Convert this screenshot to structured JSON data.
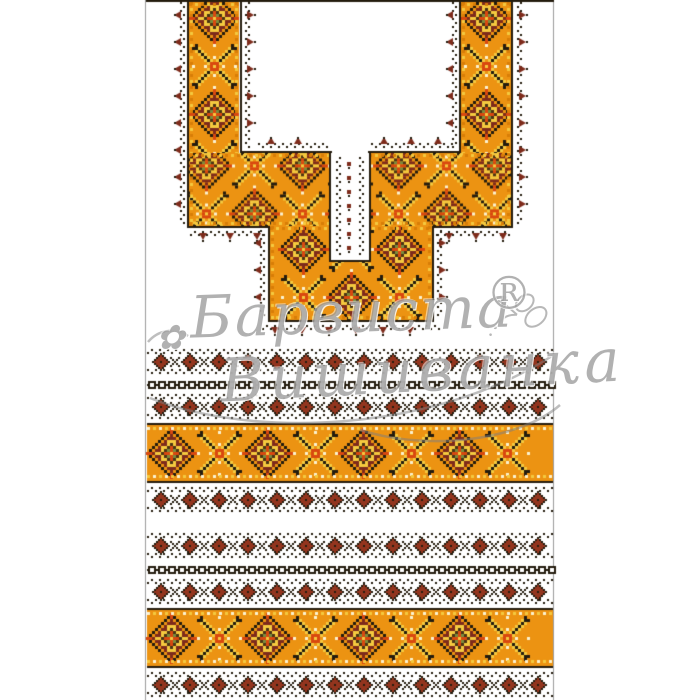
{
  "watermark": {
    "line1": "Барвиста",
    "registered": "®",
    "line2": "Вишиванка",
    "flower_icon": "✿",
    "color": "#7d7d7d"
  },
  "palette": {
    "white": "#ffffff",
    "frame_gray": "#9b9b9b",
    "orange": "#EC9312",
    "orange_deep": "#D87D07",
    "yellow": "#F4C93F",
    "cream": "#FBF2CF",
    "red": "#D9480F",
    "maroon": "#7E2B1B",
    "dark_red": "#93351E",
    "brown": "#4A3414",
    "black": "#241C0E",
    "green": "#7A8C3C"
  },
  "pattern_layout": {
    "content": {
      "x": 146,
      "w": 408
    },
    "neck": {
      "regions": [
        {
          "x": 189,
          "y": 2,
          "w": 50,
          "h": 224
        },
        {
          "x": 461,
          "y": 2,
          "w": 50,
          "h": 224
        },
        {
          "x": 189,
          "y": 153,
          "w": 322,
          "h": 73
        },
        {
          "x": 270,
          "y": 226,
          "w": 162,
          "h": 94
        }
      ],
      "slit": {
        "x": 331,
        "y": 153,
        "w": 38,
        "h": 109
      }
    },
    "bands": [
      {
        "type": "diamond-row",
        "y": 349,
        "h": 26
      },
      {
        "type": "chain-row",
        "y": 381,
        "h": 8
      },
      {
        "type": "diamond-row",
        "y": 394,
        "h": 26
      },
      {
        "type": "wide-band",
        "y": 423,
        "h": 60
      },
      {
        "type": "diamond-row",
        "y": 487,
        "h": 26
      },
      {
        "type": "diamond-row",
        "y": 533,
        "h": 26
      },
      {
        "type": "chain-row",
        "y": 566,
        "h": 8
      },
      {
        "type": "diamond-row",
        "y": 579,
        "h": 26
      },
      {
        "type": "wide-band",
        "y": 608,
        "h": 60
      },
      {
        "type": "diamond-row",
        "y": 672,
        "h": 26
      }
    ]
  }
}
